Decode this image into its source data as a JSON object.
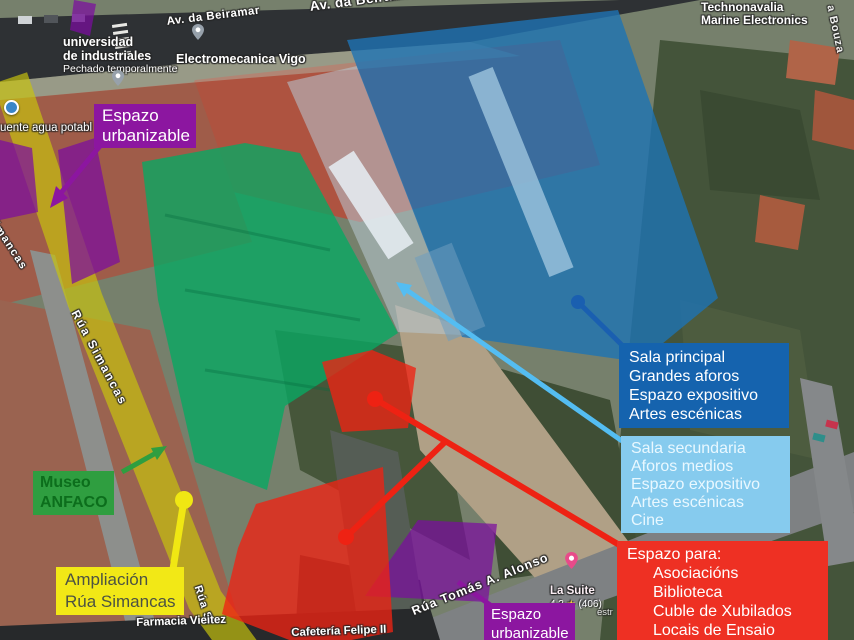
{
  "map": {
    "streets": {
      "beiramar_small": "Av. da Beiramar",
      "beiramar_large": "Av. da Beiramar",
      "simancas_top": "imancas",
      "simancas_mid": "Rúa Simancas",
      "simancas_bottom": "Rúa Si",
      "tomas_alonso": "Rúa Tomás A. Alonso",
      "bouza": "a Bouza"
    },
    "pois": {
      "universidad_line1": "universidad",
      "universidad_line2": "de industriales",
      "universidad_status": "Pechado temporalmente",
      "electromecanica": "Electromecanica Vigo",
      "technonavalia_line1": "Technonavalia",
      "technonavalia_line2": "Marine Electronics",
      "fuente": "uente agua potabl",
      "farmacia": "Farmacia Vieitez",
      "cafeteria": "Cafetería Felipe II",
      "la_suite": "La Suite",
      "la_suite_rating": "4.3",
      "la_suite_star": "★",
      "la_suite_reviews": "(406)",
      "estr_fragment": "estr"
    }
  },
  "annotations": {
    "espazo_urbanizable_top": {
      "line1": "Espazo",
      "line2": "urbanizable",
      "bg": "#8c16a0"
    },
    "espazo_urbanizable_bottom": {
      "line1": "Espazo",
      "line2": "urbanizable",
      "bg": "#8c16a0"
    },
    "museo": {
      "line1": "Museo",
      "line2": "ANFACO",
      "bg": "#2f9e40",
      "text_color": "#0c6e1c"
    },
    "ampliacion": {
      "line1": "Ampliación",
      "line2": "Rúa Simancas",
      "bg": "#f2e816",
      "text_color": "#4c5243"
    },
    "sala_principal": {
      "bg": "#1563ae",
      "lines": [
        "Sala principal",
        "Grandes aforos",
        "Espazo expositivo",
        "Artes escénicas"
      ]
    },
    "sala_secundaria": {
      "bg": "#86cbee",
      "text_color": "#e9f8ff",
      "lines": [
        "Sala secundaria",
        "Aforos medios",
        "Espazo expositivo",
        "Artes escénicas",
        "Cine"
      ]
    },
    "espazo_para": {
      "bg": "#ee3023",
      "title": "Espazo para:",
      "items": [
        "Asociacións",
        "Biblioteca",
        "Cuble de Xubilados",
        "Locais de Ensaio"
      ]
    },
    "overlay_colors": {
      "blue_building": "#1e73b4",
      "light_blue_building": "#b8c9d4",
      "green_building": "#09a863",
      "red_zones": "#ee2213",
      "yellow_street": "#c9c40e",
      "purple_zones": "#7c0ca0"
    }
  }
}
